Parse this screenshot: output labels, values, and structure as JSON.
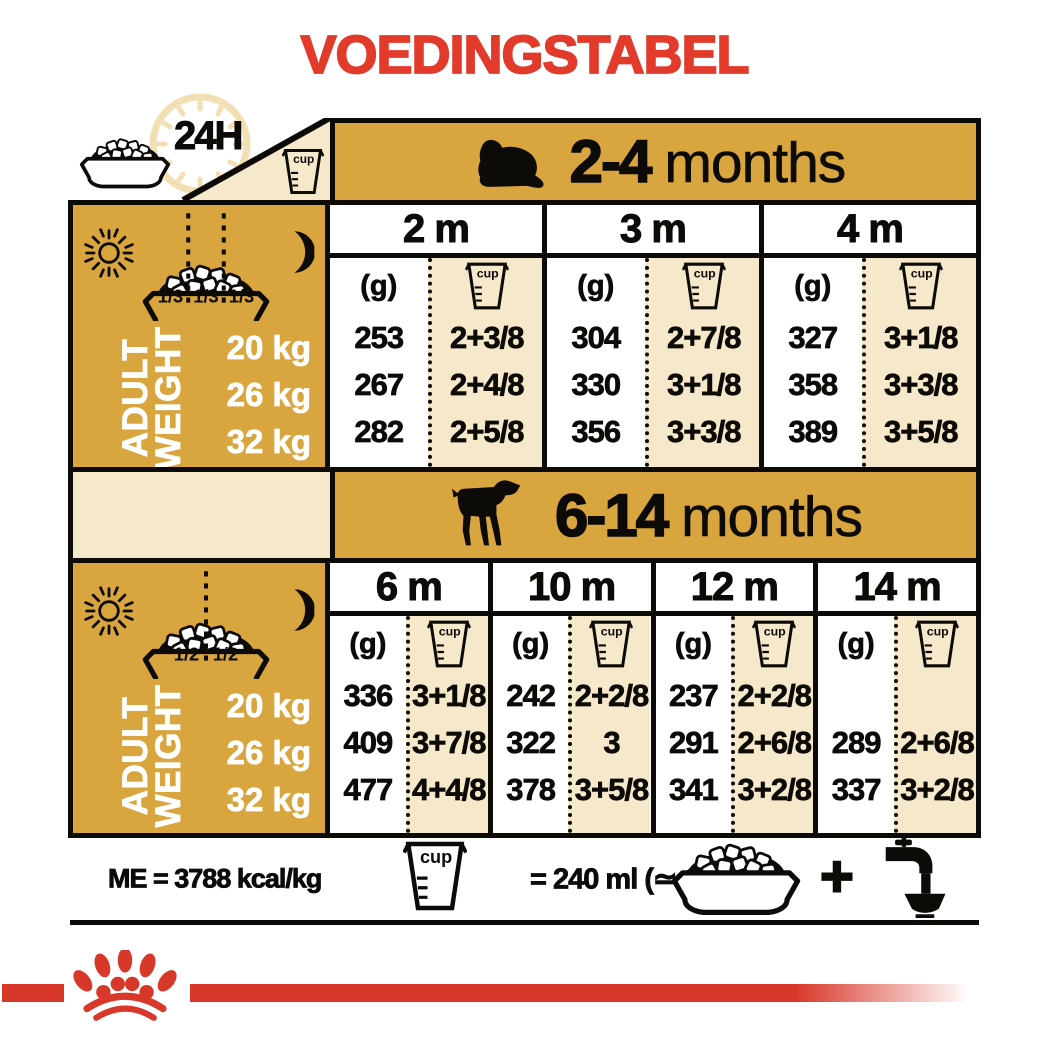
{
  "title": "VOEDINGSTABEL",
  "colors": {
    "gold": "#D8A53F",
    "cream": "#F6E8CB",
    "red": "#E23A2B",
    "logo_red": "#D8382A"
  },
  "header_block": {
    "label_24h": "24H"
  },
  "cup_label": "cup",
  "unit_g": "(g)",
  "sidebar": {
    "line1": "ADULT",
    "line2": "WEIGHT",
    "weights": [
      "20 kg",
      "26 kg",
      "32 kg"
    ]
  },
  "sections": [
    {
      "age_range": "2-4",
      "months_word": "months",
      "columns": [
        "2 m",
        "3 m",
        "4 m"
      ],
      "bowl_fractions": [
        "1/3",
        "1/3",
        "1/3"
      ],
      "data": [
        [
          [
            "253",
            "2+3/8"
          ],
          [
            "304",
            "2+7/8"
          ],
          [
            "327",
            "3+1/8"
          ]
        ],
        [
          [
            "267",
            "2+4/8"
          ],
          [
            "330",
            "3+1/8"
          ],
          [
            "358",
            "3+3/8"
          ]
        ],
        [
          [
            "282",
            "2+5/8"
          ],
          [
            "356",
            "3+3/8"
          ],
          [
            "389",
            "3+5/8"
          ]
        ]
      ]
    },
    {
      "age_range": "6-14",
      "months_word": "months",
      "columns": [
        "6 m",
        "10 m",
        "12 m",
        "14 m"
      ],
      "bowl_fractions": [
        "1/2",
        "1/2"
      ],
      "data": [
        [
          [
            "336",
            "3+1/8"
          ],
          [
            "242",
            "2+2/8"
          ],
          [
            "237",
            "2+2/8"
          ],
          [
            "",
            ""
          ]
        ],
        [
          [
            "409",
            "3+7/8"
          ],
          [
            "322",
            "3"
          ],
          [
            "291",
            "2+6/8"
          ],
          [
            "289",
            "2+6/8"
          ]
        ],
        [
          [
            "477",
            "4+4/8"
          ],
          [
            "378",
            "3+5/8"
          ],
          [
            "341",
            "3+2/8"
          ],
          [
            "337",
            "3+2/8"
          ]
        ]
      ]
    }
  ],
  "footer": {
    "me": "ME = 3788 kcal/kg",
    "equals": "= 240 ml (≃ 105 g)",
    "plus": "+"
  }
}
